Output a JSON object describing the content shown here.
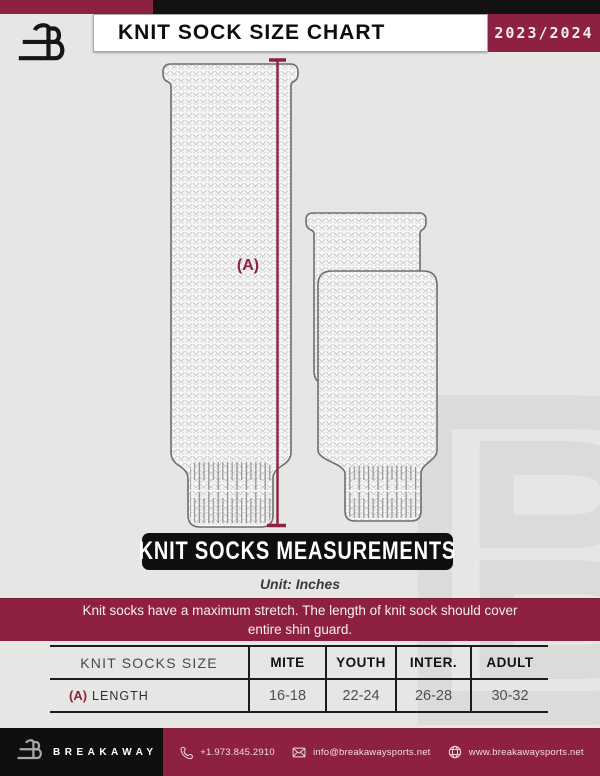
{
  "colors": {
    "maroon": "#8E2142",
    "black": "#0F0F0F",
    "background": "#E6E6E4"
  },
  "header": {
    "title": "KNIT SOCK SIZE CHART",
    "season": "2023/2024"
  },
  "diagram": {
    "dimension_label": "(A)"
  },
  "section": {
    "banner": "KNIT SOCKS MEASUREMENTS",
    "unit": "Unit: Inches"
  },
  "notice": {
    "line1": "Knit socks have a maximum stretch. The length of knit sock should cover",
    "line2": "entire shin guard."
  },
  "size_table": {
    "columns": [
      "KNIT SOCKS SIZE",
      "MITE",
      "YOUTH",
      "INTER.",
      "ADULT"
    ],
    "rows": [
      {
        "dim": "(A)",
        "label": "LENGTH",
        "values": [
          "16-18",
          "22-24",
          "26-28",
          "30-32"
        ]
      }
    ]
  },
  "footer": {
    "brand": "BREAKAWAY",
    "phone": "+1.973.845.2910",
    "email": "info@breakawaysports.net",
    "website": "www.breakawaysports.net"
  }
}
